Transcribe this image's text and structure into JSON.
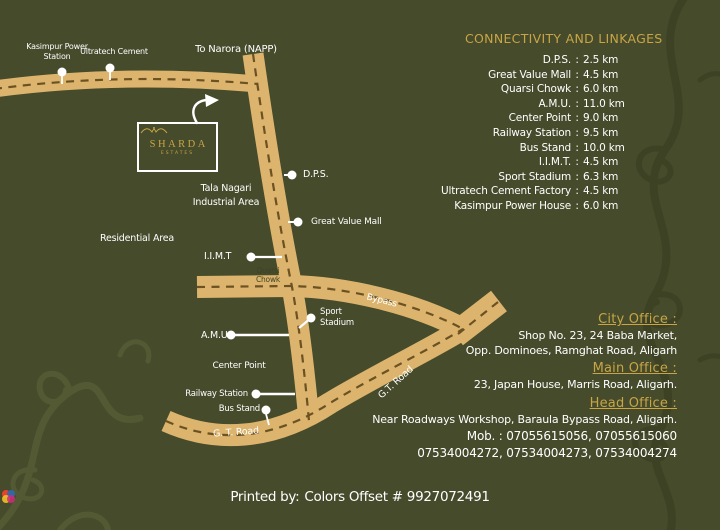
{
  "connectivity": {
    "heading": "CONNECTIVITY AND LINKAGES",
    "colon": ":",
    "items": [
      {
        "label": "D.P.S.",
        "value": "2.5 km"
      },
      {
        "label": "Great Value Mall",
        "value": "4.5 km"
      },
      {
        "label": "Quarsi Chowk",
        "value": "6.0 km"
      },
      {
        "label": "A.M.U.",
        "value": "11.0 km"
      },
      {
        "label": "Center Point",
        "value": "9.0 km"
      },
      {
        "label": "Railway Station",
        "value": "9.5 km"
      },
      {
        "label": "Bus Stand",
        "value": "10.0 km"
      },
      {
        "label": "I.I.M.T.",
        "value": "4.5 km"
      },
      {
        "label": "Sport Stadium",
        "value": "6.3 km"
      },
      {
        "label": "Ultratech Cement Factory",
        "value": "4.5 km"
      },
      {
        "label": "Kasimpur Power House",
        "value": "6.0 km"
      }
    ]
  },
  "offices": [
    {
      "heading": "City Office :",
      "line1": "Shop No. 23, 24 Baba Market,",
      "line2": "Opp. Dominoes, Ramghat Road, Aligarh"
    },
    {
      "heading": "Main Office :",
      "line1": "23, Japan House, Marris Road, Aligarh."
    },
    {
      "heading": "Head Office :",
      "line1": "Near Roadways Workshop, Baraula Bypass Road, Aligarh.",
      "mob_line": "Mob. : 07055615056, 07055615060",
      "numbers_line": "07534004272, 07534004273, 07534004274"
    }
  ],
  "map": {
    "logo": {
      "name": "SHARDA",
      "sub": "ESTATES"
    },
    "labels": {
      "to_narora": "To Narora (NAPP)",
      "kasimpur": "Kasimpur Power Station",
      "ultratech": "Ultratech Cement",
      "tala_nagari": "Tala Nagari Industrial Area",
      "dps": "D.P.S.",
      "great_value_mall": "Great Value Mall",
      "iimt": "I.I.M.T",
      "residential": "Residential Area",
      "quarsi_chowk": "Quarsi Chowk",
      "bypass": "Bypass",
      "sport_stadium": "Sport Stadium",
      "amu": "A.M.U.",
      "center_point": "Center Point",
      "railway_station": "Railway Station",
      "bus_stand": "Bus Stand",
      "gt_road_bottom": "G. T. Road",
      "gt_road_right": "G.T. Road"
    }
  },
  "footer": {
    "printed_by": "Printed by:",
    "printer": "Colors Offset # 9927072491",
    "logo_colors": [
      "#e8412c",
      "#2b6bb3",
      "#f2c028",
      "#cf2a7b"
    ]
  },
  "colors": {
    "background": "#454b2b",
    "road": "#dcb46e",
    "road_dash": "#6b5222",
    "gold": "#c9a546",
    "text": "#ffffff"
  }
}
